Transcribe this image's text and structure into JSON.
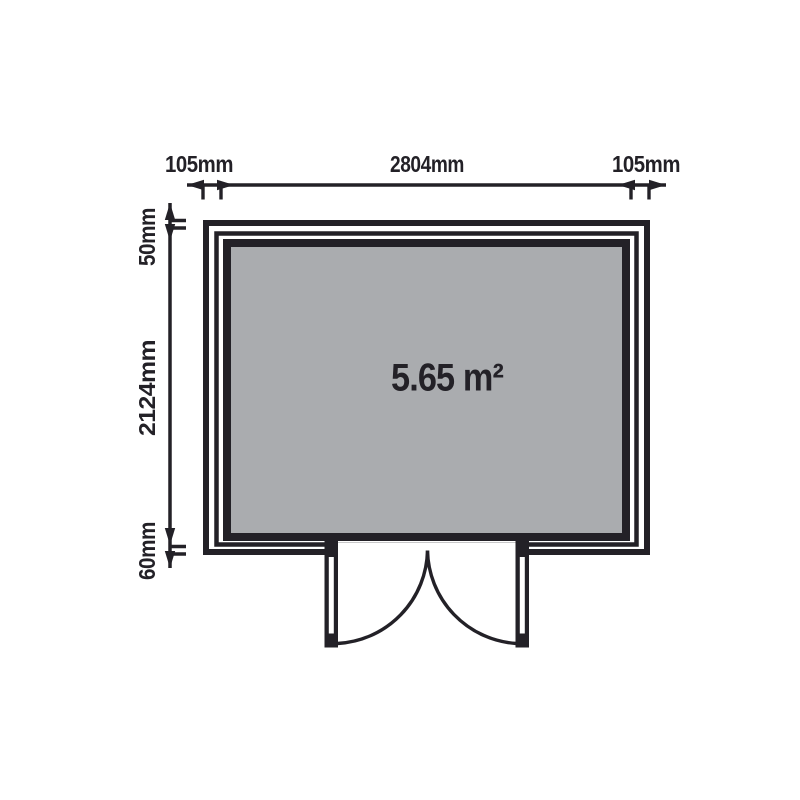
{
  "diagram": {
    "title": "floor-plan",
    "area_label": "5.65 m²",
    "dimensions": {
      "top_left": "105mm",
      "top_center": "2804mm",
      "top_right": "105mm",
      "side_top": "50mm",
      "side_middle": "2124mm",
      "side_bottom": "60mm"
    },
    "colors": {
      "ink": "#232127",
      "floor_fill": "#aaacaf",
      "background": "#ffffff"
    }
  }
}
